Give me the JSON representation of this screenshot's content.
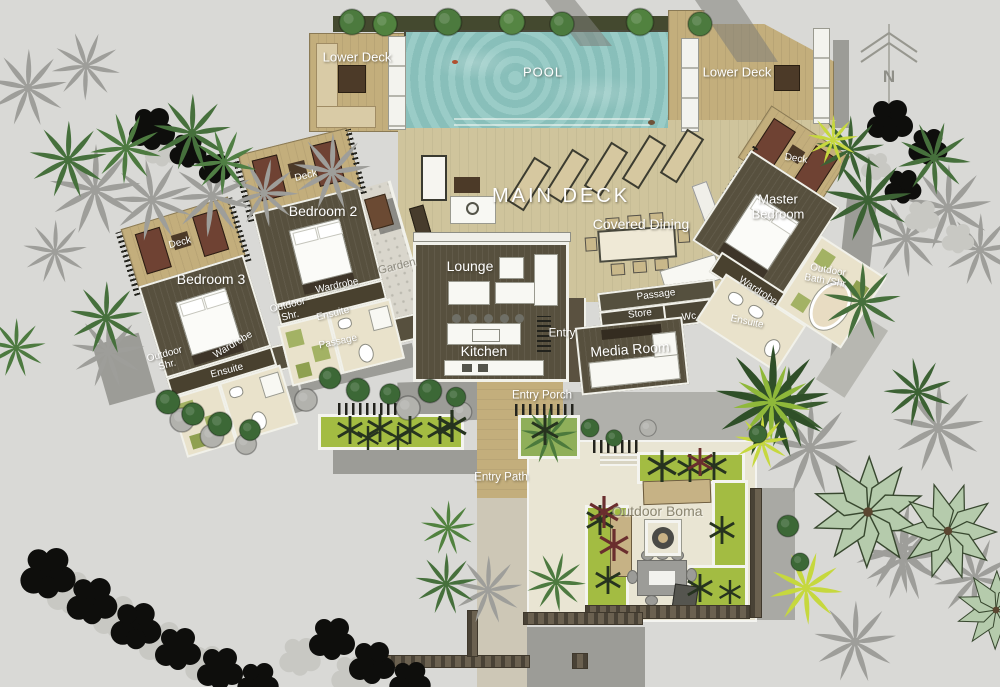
{
  "plan_title": "Villa site plan",
  "labels": {
    "pool": "POOL",
    "lower_deck_left": "Lower Deck",
    "lower_deck_right": "Lower Deck",
    "main_deck": "MAIN DECK",
    "covered_dining": "Covered Dining",
    "lounge": "Lounge",
    "kitchen": "Kitchen",
    "entry": "Entry",
    "media_room": "Media Room",
    "passage": "Passage",
    "store": "Store",
    "wc": "Wc",
    "garden": "Garden",
    "entry_porch": "Entry Porch",
    "entry_path": "Entry Path",
    "outdoor_boma": "Outdoor Boma",
    "compass_north": "N"
  },
  "bedroom2": {
    "name": "Bedroom 2",
    "deck": "Deck",
    "wardrobe": "Wardrobe",
    "ensuite": "Ensuite",
    "outdoor_shower_1": "Outdoor",
    "outdoor_shower_2": "Shr.",
    "passage": "Passage"
  },
  "bedroom3": {
    "name": "Bedroom 3",
    "deck": "Deck",
    "wardrobe": "Wardrobe",
    "ensuite": "Ensuite",
    "outdoor_shower_1": "Outdoor",
    "outdoor_shower_2": "Shr."
  },
  "master": {
    "name_1": "Master",
    "name_2": "Bedroom",
    "deck": "Deck",
    "wardrobe": "Wardrobe",
    "ensuite": "Ensuite",
    "outdoor_bath_1": "Outdoor",
    "outdoor_bath_2": "Bath /Shr."
  },
  "colors": {
    "background": "#d9d9d6",
    "pool_water": "#8fc6c1",
    "deck_tan": "#c3ae7c",
    "main_deck_tan": "#cfc49c",
    "room_floor": "#57503e",
    "tile_cream": "#e9e2cb",
    "planting_green": "#a3bc42",
    "palm_green": "#46703c",
    "shadow_gray": "#9c9c97",
    "tree_black": "#0e0e0c",
    "lounger_maroon": "#6f4233",
    "stone_wall": "#6b6150"
  }
}
